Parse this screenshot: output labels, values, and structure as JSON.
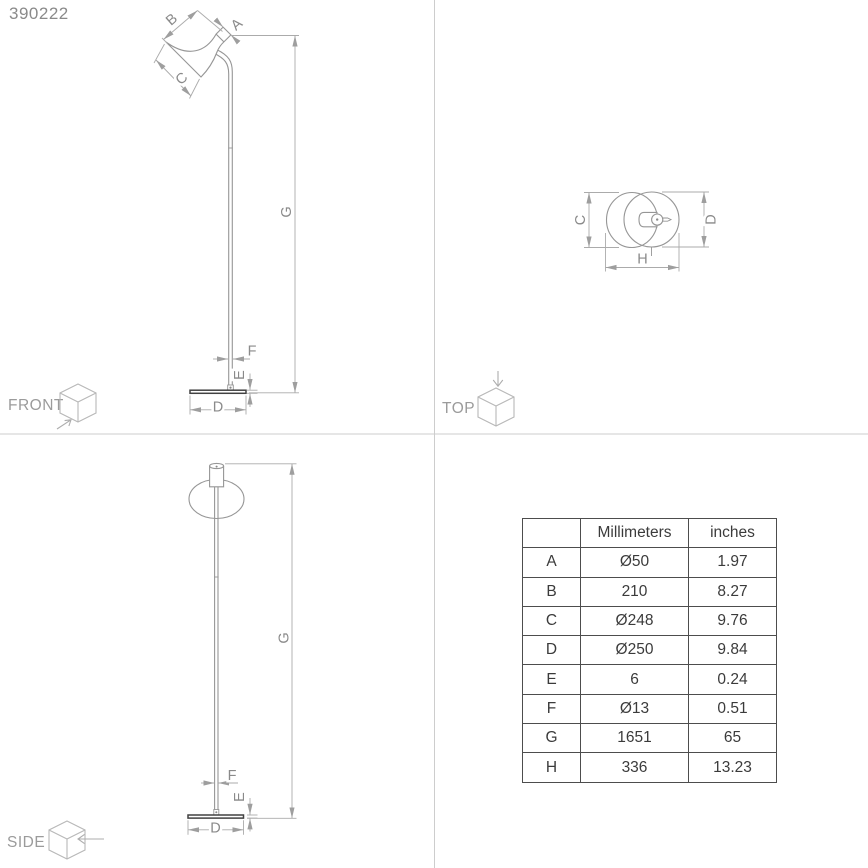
{
  "product_code": "390222",
  "views": {
    "front": {
      "label": "FRONT"
    },
    "top": {
      "label": "TOP"
    },
    "side": {
      "label": "SIDE"
    }
  },
  "dims": {
    "A": "A",
    "B": "B",
    "C": "C",
    "D": "D",
    "E": "E",
    "F": "F",
    "G": "G",
    "H": "H"
  },
  "table": {
    "headers": {
      "dim": "",
      "mm": "Millimeters",
      "in": "inches"
    },
    "rows": [
      {
        "dim": "A",
        "mm": "Ø50",
        "in": "1.97"
      },
      {
        "dim": "B",
        "mm": "210",
        "in": "8.27"
      },
      {
        "dim": "C",
        "mm": "Ø248",
        "in": "9.76"
      },
      {
        "dim": "D",
        "mm": "Ø250",
        "in": "9.84"
      },
      {
        "dim": "E",
        "mm": "6",
        "in": "0.24"
      },
      {
        "dim": "F",
        "mm": "Ø13",
        "in": "0.51"
      },
      {
        "dim": "G",
        "mm": "1651",
        "in": "65"
      },
      {
        "dim": "H",
        "mm": "336",
        "in": "13.23"
      }
    ]
  },
  "colors": {
    "object_line": "#969696",
    "dim_line": "#ababab",
    "label": "#8a8a8a",
    "base_dark": "#414141",
    "divider": "#cdcdcd",
    "table_border": "#4d4d4d",
    "table_text": "#3b3b3b"
  }
}
